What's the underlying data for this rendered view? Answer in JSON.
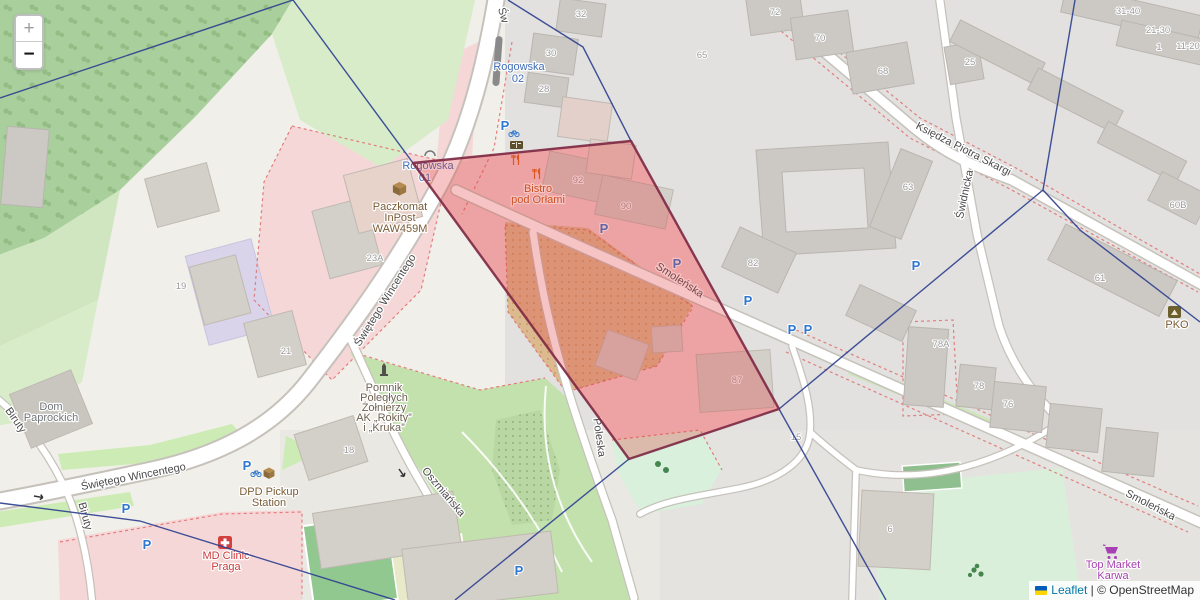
{
  "controls": {
    "zoom_in": "+",
    "zoom_out": "−"
  },
  "attribution": {
    "flag_icon": "ukraine-flag-icon",
    "link": "Leaflet",
    "separator": "|",
    "text": "© OpenStreetMap"
  },
  "colors": {
    "boundary_line": "#2f4190",
    "zone_fill": "#e23b3b",
    "zone_stroke": "#7c2742",
    "transit_blue": "#3f6cb5",
    "parking_blue": "#2f77d1",
    "amenity_brown": "#7a5b35",
    "memorial_brown": "#6d6051",
    "building_gray": "#6f7478",
    "restaurant_orange": "#c45a18",
    "clinic_red": "#cc3b3b",
    "market_purple": "#a63fb0",
    "street_gray": "#4a4a4a",
    "housenum_gray": "#9a9a9a"
  },
  "zone": {
    "points": [
      [
        413,
        163
      ],
      [
        631,
        141
      ],
      [
        779,
        409
      ],
      [
        629,
        459
      ]
    ],
    "fill_opacity": 0.3
  },
  "boundary_lines": [
    [
      [
        293,
        0
      ],
      [
        413,
        163
      ]
    ],
    [
      [
        293,
        0
      ],
      [
        0,
        98
      ]
    ],
    [
      [
        508,
        0
      ],
      [
        583,
        47
      ],
      [
        631,
        141
      ]
    ],
    [
      [
        1075,
        0
      ],
      [
        1043,
        190
      ]
    ],
    [
      [
        1043,
        190
      ],
      [
        1080,
        230
      ],
      [
        1200,
        322
      ]
    ],
    [
      [
        1043,
        190
      ],
      [
        779,
        409
      ]
    ],
    [
      [
        779,
        409
      ],
      [
        886,
        600
      ]
    ],
    [
      [
        629,
        459
      ],
      [
        455,
        600
      ]
    ],
    [
      [
        0,
        503
      ],
      [
        140,
        521
      ],
      [
        395,
        600
      ]
    ]
  ],
  "street_labels": [
    {
      "text": "Świętego Wincentego",
      "x": 388,
      "y": 302,
      "rotate": -58
    },
    {
      "text": "Świętego Wincentego",
      "x": 134,
      "y": 480,
      "rotate": -11
    },
    {
      "text": "Św",
      "x": 500,
      "y": 16,
      "rotate": 75
    },
    {
      "text": "Smoleńska",
      "x": 678,
      "y": 283,
      "rotate": 33
    },
    {
      "text": "Smoleńska",
      "x": 1149,
      "y": 508,
      "rotate": 27
    },
    {
      "text": "Księdza Piotra Skargi",
      "x": 962,
      "y": 152,
      "rotate": 27
    },
    {
      "text": "Świdnicka",
      "x": 968,
      "y": 195,
      "rotate": -78
    },
    {
      "text": "Poleska",
      "x": 596,
      "y": 438,
      "rotate": 82
    },
    {
      "text": "Oszmiańska",
      "x": 441,
      "y": 494,
      "rotate": 50
    },
    {
      "text": "Biruty",
      "x": 13,
      "y": 422,
      "rotate": 55
    },
    {
      "text": "Biruty",
      "x": 82,
      "y": 517,
      "rotate": 75
    }
  ],
  "house_numbers": [
    {
      "text": "32",
      "x": 581,
      "y": 17
    },
    {
      "text": "30",
      "x": 551,
      "y": 56
    },
    {
      "text": "28",
      "x": 544,
      "y": 92
    },
    {
      "text": "92",
      "x": 578,
      "y": 183
    },
    {
      "text": "90",
      "x": 626,
      "y": 209
    },
    {
      "text": "82",
      "x": 753,
      "y": 266
    },
    {
      "text": "87",
      "x": 737,
      "y": 383
    },
    {
      "text": "65",
      "x": 702,
      "y": 58
    },
    {
      "text": "72",
      "x": 775,
      "y": 15
    },
    {
      "text": "70",
      "x": 820,
      "y": 41
    },
    {
      "text": "68",
      "x": 883,
      "y": 74
    },
    {
      "text": "25",
      "x": 970,
      "y": 65
    },
    {
      "text": "63",
      "x": 908,
      "y": 190
    },
    {
      "text": "60B",
      "x": 1178,
      "y": 208
    },
    {
      "text": "61",
      "x": 1100,
      "y": 281
    },
    {
      "text": "78A",
      "x": 941,
      "y": 347
    },
    {
      "text": "78",
      "x": 979,
      "y": 389
    },
    {
      "text": "76",
      "x": 1008,
      "y": 407
    },
    {
      "text": "31-40",
      "x": 1128,
      "y": 14
    },
    {
      "text": "21-30",
      "x": 1158,
      "y": 33
    },
    {
      "text": "1",
      "x": 1159,
      "y": 50
    },
    {
      "text": "11-20",
      "x": 1188,
      "y": 49
    },
    {
      "text": "23A",
      "x": 375,
      "y": 261
    },
    {
      "text": "19",
      "x": 181,
      "y": 289
    },
    {
      "text": "21",
      "x": 286,
      "y": 354
    },
    {
      "text": "18",
      "x": 349,
      "y": 453
    },
    {
      "text": "15",
      "x": 796,
      "y": 440
    },
    {
      "text": "6",
      "x": 890,
      "y": 532
    }
  ],
  "transit_labels": [
    {
      "text": "Rogowska",
      "x": 519,
      "y": 70
    },
    {
      "text": "02",
      "x": 518,
      "y": 82
    },
    {
      "text": "Rogowska",
      "x": 428,
      "y": 169
    },
    {
      "text": "01",
      "x": 425,
      "y": 181
    }
  ],
  "poi_labels": [
    {
      "lines": [
        "Paczkomat",
        "InPost",
        "WAW459M"
      ],
      "x": 400,
      "y": 210,
      "color_key": "amenity_brown"
    },
    {
      "lines": [
        "Bistro",
        "pod Orłami"
      ],
      "x": 538,
      "y": 192,
      "color_key": "restaurant_orange"
    },
    {
      "lines": [
        "DPD Pickup",
        "Station"
      ],
      "x": 269,
      "y": 495,
      "color_key": "amenity_brown"
    },
    {
      "lines": [
        "MD Clinic",
        "Praga"
      ],
      "x": 226,
      "y": 559,
      "color_key": "clinic_red"
    },
    {
      "lines": [
        "Pomnik",
        "Poległych",
        "Żołnierzy",
        "AK „Rokity”",
        "i „Kruka”"
      ],
      "x": 384,
      "y": 391,
      "color_key": "memorial_brown",
      "size": 10.5,
      "dy": 10
    },
    {
      "lines": [
        "Dom",
        "Paprockich"
      ],
      "x": 51,
      "y": 410,
      "color_key": "building_gray"
    },
    {
      "lines": [
        "PKO"
      ],
      "x": 1177,
      "y": 328,
      "color_key": "amenity_brown"
    },
    {
      "lines": [
        "Top Market",
        "Karwa"
      ],
      "x": 1113,
      "y": 568,
      "color_key": "market_purple"
    }
  ],
  "parking_icons": [
    {
      "x": 604,
      "y": 233,
      "bike": false
    },
    {
      "x": 677,
      "y": 268,
      "bike": false
    },
    {
      "x": 748,
      "y": 305,
      "bike": false
    },
    {
      "x": 792,
      "y": 334,
      "bike": false
    },
    {
      "x": 808,
      "y": 334,
      "bike": false
    },
    {
      "x": 916,
      "y": 270,
      "bike": false
    },
    {
      "x": 126,
      "y": 513,
      "bike": false
    },
    {
      "x": 147,
      "y": 549,
      "bike": false
    },
    {
      "x": 519,
      "y": 575,
      "bike": false
    },
    {
      "x": 505,
      "y": 130,
      "bike": true
    },
    {
      "x": 247,
      "y": 470,
      "bike": true
    }
  ]
}
